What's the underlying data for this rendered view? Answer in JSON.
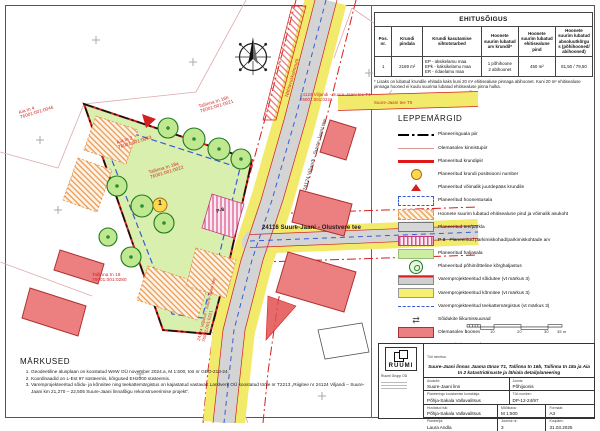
{
  "ehitusoigus_table": {
    "title": "EHITUSÕIGUS",
    "headers": [
      "Pos. nr.",
      "Krundi pindala",
      "Krundi kasutamise sihtotstarbed",
      "Hoonete suurim lubatud arv krundil*",
      "Hoonete suurim lubatud ehitisealune pind",
      "Hoonete suurim lubatud absoluutkõrgus (põhihooned/ abihooned)"
    ],
    "row_cells": [
      "1",
      "2169 m²",
      "EP - üksikelamu maa\nEPk - kaksikelamu maa\nER - ridaelamu maa",
      "1 põhihoone\n2 abihoonet",
      "450 m²",
      "81,50 / 79,50"
    ],
    "footnote": "* Lisaks on lubatud krundile ehitada kaks kuni 20 m² ehitisealuse pinnaga abihoonet. Kuni 20 m² ehitisealuse pinnaga hooned ei kuulu suurima lubatud ehitisealuse pinna hulka."
  },
  "legend": {
    "title": "LEPPEMÄRGID",
    "items": [
      {
        "swatch": "s-paala",
        "label": "Planeeringuala piir"
      },
      {
        "swatch": "s-kinnistu",
        "label": "Olemasolev kinnistupiir"
      },
      {
        "swatch": "s-krunt",
        "label": "Planeeritud krundipiir"
      },
      {
        "swatch": "s-pos",
        "glyph": "1",
        "label": "Planeeritud krundi positsiooni number"
      },
      {
        "swatch": "s-access",
        "label": "Planeeritud võimalik juurdepääs krundile"
      },
      {
        "swatch": "s-hoonestus",
        "label": "Planeeritud hoonestusala"
      },
      {
        "swatch": "s-ehitisealune",
        "label": "Hoonete suurim lubatud ehitisealune pind ja võimalik asukoht"
      },
      {
        "swatch": "s-tee",
        "label": "Planeeritud tee/parkla"
      },
      {
        "swatch": "s-parkimine",
        "extra": "P-8",
        "label": "Planeeritud parkimiskohad/parkimiskohtade arv"
      },
      {
        "swatch": "s-haljasala",
        "label": "Planeeritud haljasala"
      },
      {
        "swatch": "s-korghaljastus",
        "label": "Planeeritud põhimõtteline kõrghaljastus"
      },
      {
        "swatch": "s-varemtee",
        "label": "Varemprojekteeritud sõidutee (vt märkus 3)"
      },
      {
        "swatch": "s-varemkonni",
        "label": "Varemprojekteeritud kõnnitee (vt märkus 3)"
      },
      {
        "swatch": "s-markistus",
        "label": "Varemprojekteeritud teekattemärgistus (vt märkus 3)"
      },
      {
        "swatch": "s-suunad",
        "label": "Sõidukite liikumissuunad"
      },
      {
        "swatch": "s-olemasolev",
        "label": "Olemasolev hoone"
      },
      {
        "swatch": "s-kaitse",
        "label": "Tänava kaitsevöönd 10 m"
      },
      {
        "swatch": "s-nahtavus",
        "label": "Nähtavuskolmnurk"
      }
    ]
  },
  "notes": {
    "title": "MÄRKUSED",
    "items": [
      "Geodeetiline alusplaan on koostatud WeW OÜ november 2024.a, M 1:500, töö nr GEO-213-24.",
      "Koordinaadid on L-Est 97 süsteemis, kõrgused EH2000 süsteemis.",
      "Varemprojekteeritud sõidu- ja kõnnitee ning teekattemärgistus on kajastatud vastavalt Landverk OÜ koostatud tööle nr T2213 „Riigitee nr 24124 Viljandi – Suure-Jaani km 21,270 – 22,505 Suure-Jaani linnalõigu rekonstrueerimise projekt“."
    ]
  },
  "titleblock": {
    "logo_text": "RUUMI",
    "company": "Ruumi Grupp OÜ",
    "project_label": "Töö nimetus:",
    "project": "Suure-Jaani linnas Jaama tänav T1, Tallinna tn 16b, Tallinna tn 18a ja Aia tn 2 katastriüksuste ja lähiala detailplaneering",
    "fields": [
      {
        "label": "Asukoht:",
        "value": "Suure-Jaani linn"
      },
      {
        "label": "Joonis:",
        "value": "Põhijoonis"
      },
      {
        "label": "Planeeringu koostamise korraldaja:",
        "value": "Põhja-Sakala Vallavalitsus"
      },
      {
        "label": "Töö number:",
        "value": "DP-12-24/97"
      },
      {
        "label": "Huvitatud isik:",
        "value": "Põhja-Sakala Vallavalitsus"
      },
      {
        "label": "Mõõtkava:",
        "value": "M 1:500"
      },
      {
        "label": "Formaat:",
        "value": "A3"
      },
      {
        "label": "Planeerija:",
        "value": "Laura Andla"
      },
      {
        "label": "Joonise nr:",
        "value": "3"
      },
      {
        "label": "Kuupäev:",
        "value": "31.03.2025"
      }
    ]
  },
  "map": {
    "position_number": "1",
    "labels": [
      {
        "text": "24124 Viljandi - Suure-Jaani tee",
        "x": 303,
        "y": 190,
        "rot": -74,
        "color": "#3a3a3a",
        "size": 5
      },
      {
        "text": "24116 Suure-Jaani - Olustvere tee",
        "x": 262,
        "y": 225,
        "color": "#1a1a1a",
        "size": 6,
        "bold": true
      },
      {
        "text": "Aia tn 2\n76001:001:0063",
        "x": 116,
        "y": 140,
        "rot": -17,
        "color": "#d42020",
        "size": 4.6
      },
      {
        "text": "Tallinna tn 16b\n76001:001:0021",
        "x": 198,
        "y": 104,
        "rot": -17,
        "color": "#d42020",
        "size": 4.6
      },
      {
        "text": "Tallinna tn 18a\n76001:001:0022",
        "x": 148,
        "y": 170,
        "rot": -17,
        "color": "#d42020",
        "size": 4.6
      },
      {
        "text": "Tallinna tn 18\n76001:001:0280",
        "x": 92,
        "y": 272,
        "color": "#d42020",
        "size": 4.6
      },
      {
        "text": "Aia tn 4\n76001:001:0046",
        "x": 18,
        "y": 110,
        "rot": -17,
        "color": "#d42020",
        "size": 4.6
      },
      {
        "text": "24124 Viljandi - Suure-Jaani tee T4\n76001:001:0221",
        "x": 300,
        "y": 92,
        "color": "#d42020",
        "size": 4.3
      },
      {
        "text": "Suure-Jaani tee T9",
        "x": 374,
        "y": 100,
        "color": "#d42020",
        "size": 4.3
      },
      {
        "text": "Nähtavuskolmnurk",
        "x": 284,
        "y": 96,
        "rot": -74,
        "color": "#d42020",
        "size": 4.6
      },
      {
        "text": "24124 Viljandi - Suure-Jaani tee\n76001:001:0221",
        "x": 196,
        "y": 340,
        "rot": -76,
        "color": "#d42020",
        "size": 4.3
      },
      {
        "text": "P-8",
        "x": 216,
        "y": 210,
        "rot": -17,
        "color": "#222",
        "size": 5,
        "bold": true
      },
      {
        "text": "1",
        "x": 158,
        "y": 200,
        "color": "#222",
        "size": 7,
        "bold": true
      }
    ]
  },
  "scalebar": {
    "ticks": [
      {
        "text": "0",
        "x": 465,
        "y": 330
      },
      {
        "text": "5",
        "x": 478,
        "y": 330
      },
      {
        "text": "10",
        "x": 490,
        "y": 330
      },
      {
        "text": "20",
        "x": 517,
        "y": 330
      },
      {
        "text": "30",
        "x": 544,
        "y": 330
      },
      {
        "text": "35 m",
        "x": 557,
        "y": 330
      }
    ]
  },
  "colors": {
    "planned_plot_red": "#e01818",
    "road_gray": "#d4d4d4",
    "sidewalk_yellow": "#f2ea6a",
    "green_area": "#d9efad",
    "existing_building_red": "#ec8080",
    "building_zone_blue": "#3b5bd6",
    "footprint_orange": "#e8944a"
  }
}
